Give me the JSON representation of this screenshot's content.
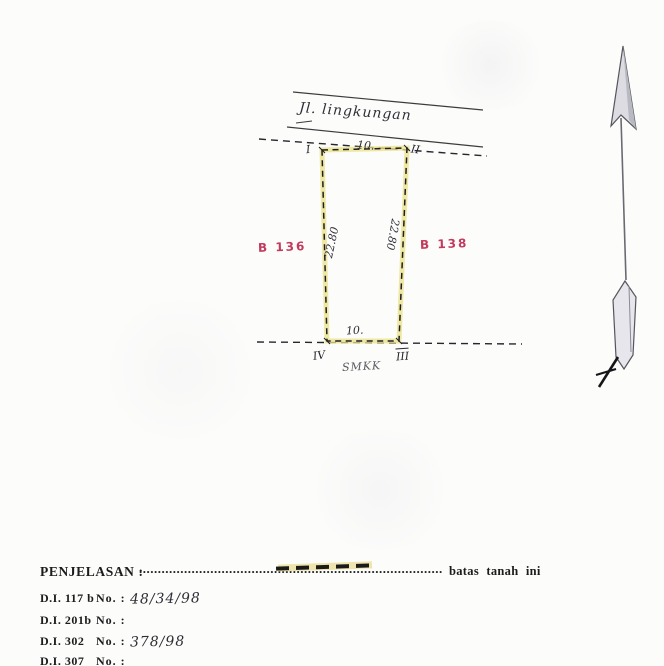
{
  "diagram": {
    "road_label": "Jl. lingkungan",
    "parcel_left_label": "B 136",
    "parcel_right_label": "B 138",
    "label_color": "#c23b5d",
    "highlight_color": "#e9e185",
    "corners": {
      "top_left": "I",
      "top_right": "II",
      "bottom_right": "III",
      "bottom_left": "IV"
    },
    "dimensions": {
      "top": "10.",
      "bottom": "10.",
      "left": "22.80",
      "right": "22.80"
    },
    "note_below": "SMKK",
    "icons": {
      "north_arrow": "north-arrow"
    }
  },
  "legend": {
    "title": "PENJELASAN :",
    "leader_dots": "...........................................................................................",
    "meaning": "batas tanah ini"
  },
  "records": [
    {
      "label": "D.I. 117 b",
      "sep": "No. :",
      "value": "48/34/98"
    },
    {
      "label": "D.I. 201b",
      "sep": "No. :",
      "value": ""
    },
    {
      "label": "D.I. 302",
      "sep": "No. :",
      "value": "378/98"
    },
    {
      "label": "D.I. 307",
      "sep": "No. :",
      "value": ""
    }
  ]
}
